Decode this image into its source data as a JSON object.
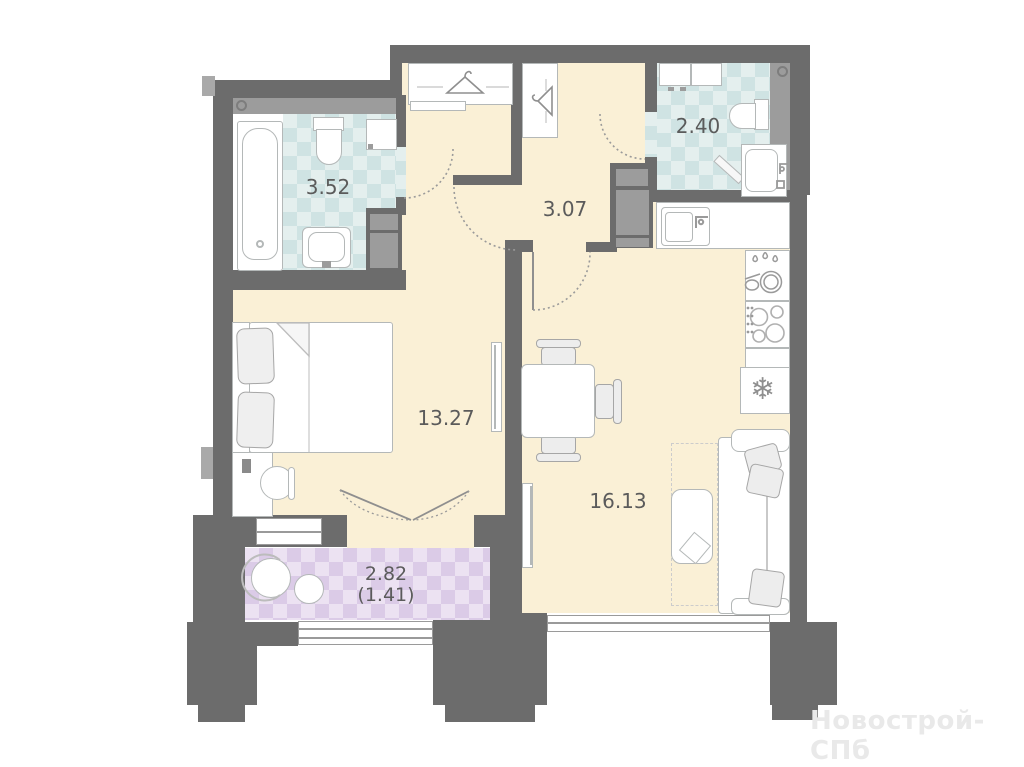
{
  "rooms": {
    "bathroom": {
      "name": "bathroom",
      "area": "3.52"
    },
    "toilet": {
      "name": "toilet",
      "area": "2.40"
    },
    "hallway": {
      "name": "hallway",
      "area": "3.07"
    },
    "bedroom": {
      "name": "bedroom",
      "area": "13.27"
    },
    "living_kitchen": {
      "name": "living-kitchen",
      "area": "16.13"
    },
    "balcony": {
      "name": "balcony",
      "area": "2.82",
      "area_reduced": "(1.41)"
    }
  },
  "watermark": "Новострой-СПб",
  "icons": {
    "snowflake_glyph": "❄"
  },
  "colors": {
    "wall": "#6c6c6c",
    "floor": "#faf0d6",
    "tile_teal": "#cfe3e3",
    "tile_purple": "#dbcbe7",
    "label_text": "#5b5b5b",
    "watermark_text": "#e9e9e9"
  }
}
